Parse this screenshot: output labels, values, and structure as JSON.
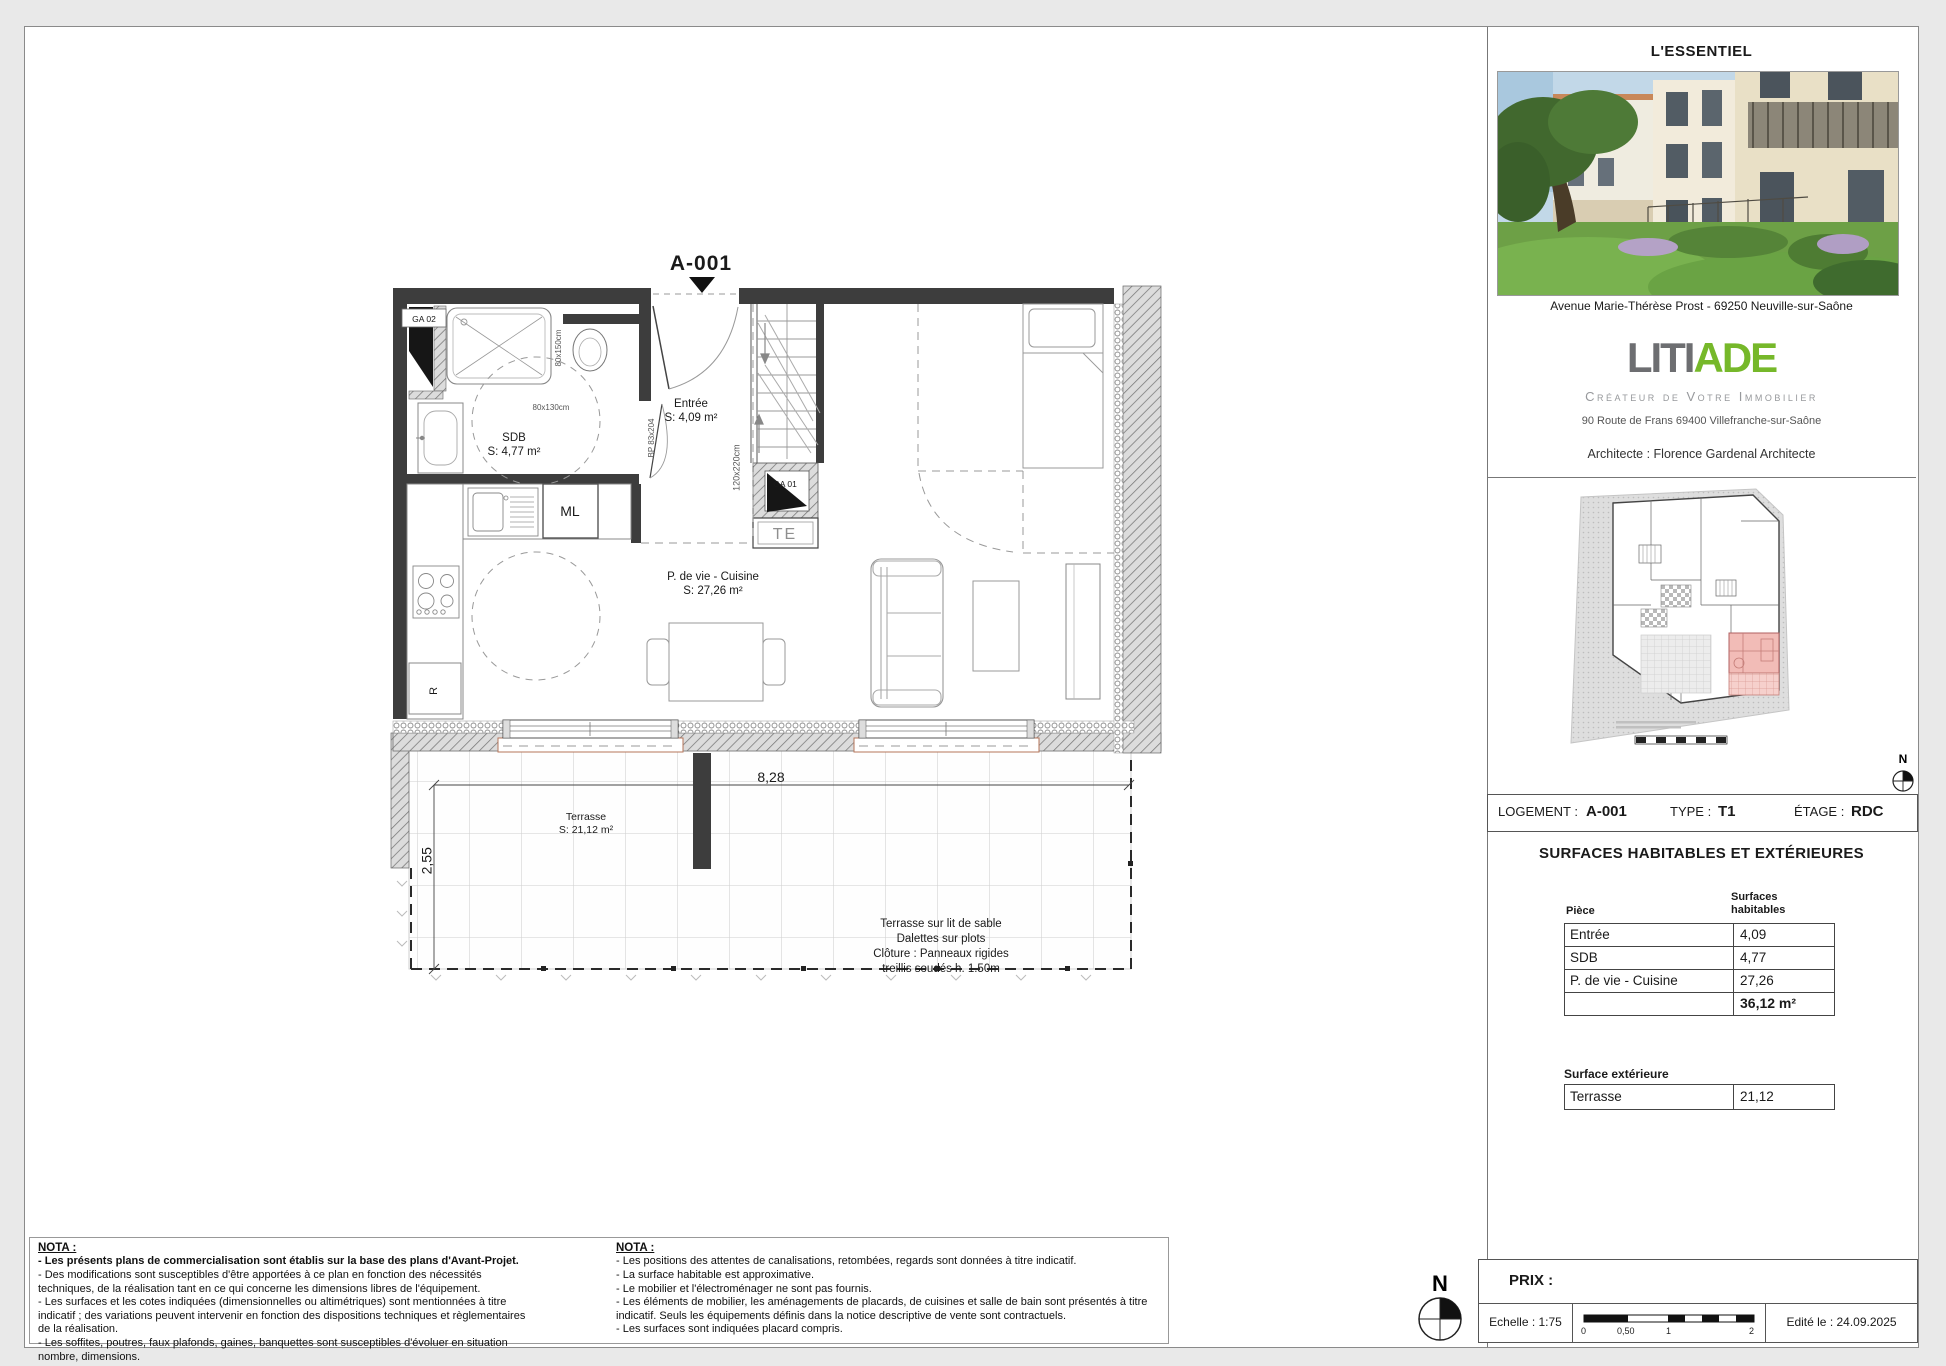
{
  "plan": {
    "unit": "A-001",
    "rooms": [
      {
        "name": "Entrée",
        "area": "S: 4,09 m²"
      },
      {
        "name": "SDB",
        "area": "S: 4,77 m²"
      },
      {
        "name": "P. de vie - Cuisine",
        "area": "S: 27,26 m²"
      },
      {
        "name": "Terrasse",
        "area": "S: 21,12 m²"
      }
    ],
    "equipment": {
      "ml": "ML",
      "te": "TE",
      "fridge": "R",
      "ga01": "GA 01",
      "ga02": "GA 02"
    },
    "dimensions": {
      "terrace_width": "8,28",
      "terrace_depth": "2,55",
      "shower": "80x150cm",
      "bath_clearance": "80x130cm",
      "stair_opening": "120x220cm",
      "door": "BP 83x204"
    },
    "terrace_note": [
      "Terrasse sur lit de sable",
      "Dalettes sur plots",
      "Clôture : Panneaux rigides",
      "treillis soudés h. 1.50m"
    ]
  },
  "sidebar": {
    "essentiel_title": "L'ESSENTIEL",
    "address": "Avenue Marie-Thérèse Prost - 69250 Neuville-sur-Saône",
    "logo": {
      "part1": "LITI",
      "part2": "ADE",
      "tagline": "Créateur de Votre Immobilier",
      "address": "90 Route de Frans 69400 Villefranche-sur-Saône"
    },
    "architect": "Architecte : Florence Gardenal Architecte",
    "north": "N",
    "logement": {
      "label": "LOGEMENT :",
      "value": "A-001",
      "type_label": "TYPE :",
      "type_value": "T1",
      "etage_label": "ÉTAGE :",
      "etage_value": "RDC"
    },
    "surfaces": {
      "title": "SURFACES HABITABLES ET EXTÉRIEURES",
      "col1": "Pièce",
      "col2_line1": "Surfaces",
      "col2_line2": "habitables",
      "rows": [
        [
          "Entrée",
          "4,09"
        ],
        [
          "SDB",
          "4,77"
        ],
        [
          "P. de vie - Cuisine",
          "27,26"
        ]
      ],
      "total": "36,12 m²",
      "ext_title": "Surface extérieure",
      "ext_rows": [
        [
          "Terrasse",
          "21,12"
        ]
      ]
    }
  },
  "titleblock": {
    "prix_label": "PRIX :",
    "echelle": "Echelle : 1:75",
    "scale_ticks": [
      "0",
      "0,50",
      "1",
      "2"
    ],
    "edited": "Edité le : 24.09.2025",
    "north": "N"
  },
  "nota1": {
    "title": "NOTA :",
    "items": [
      "- Les présents plans de commercialisation sont établis sur la base des plans d'Avant-Projet.",
      "- Des modifications sont susceptibles d'être apportées à ce plan en fonction des nécessités techniques, de la réalisation tant en ce qui concerne les dimensions libres de l'équipement.",
      "- Les surfaces et les cotes indiquées (dimensionnelles ou altimétriques) sont mentionnées à titre indicatif ; des variations peuvent intervenir en fonction des dispositions techniques et règlementaires de la réalisation.",
      "- Les soffites, poutres, faux plafonds, gaines, banquettes sont susceptibles d'évoluer en situation nombre, dimensions."
    ]
  },
  "nota2": {
    "title": "NOTA :",
    "items": [
      "- Les positions des attentes de canalisations, retombées, regards sont données à titre indicatif.",
      "- La surface habitable est approximative.",
      "- Le mobilier et l'électroménager ne sont pas fournis.",
      "- Les éléments de mobilier, les aménagements de placards, de cuisines et salle de bain sont présentés à titre indicatif. Seuls les équipements définis dans la notice descriptive de vente sont contractuels.",
      "- Les surfaces sont indiquées placard compris."
    ]
  }
}
